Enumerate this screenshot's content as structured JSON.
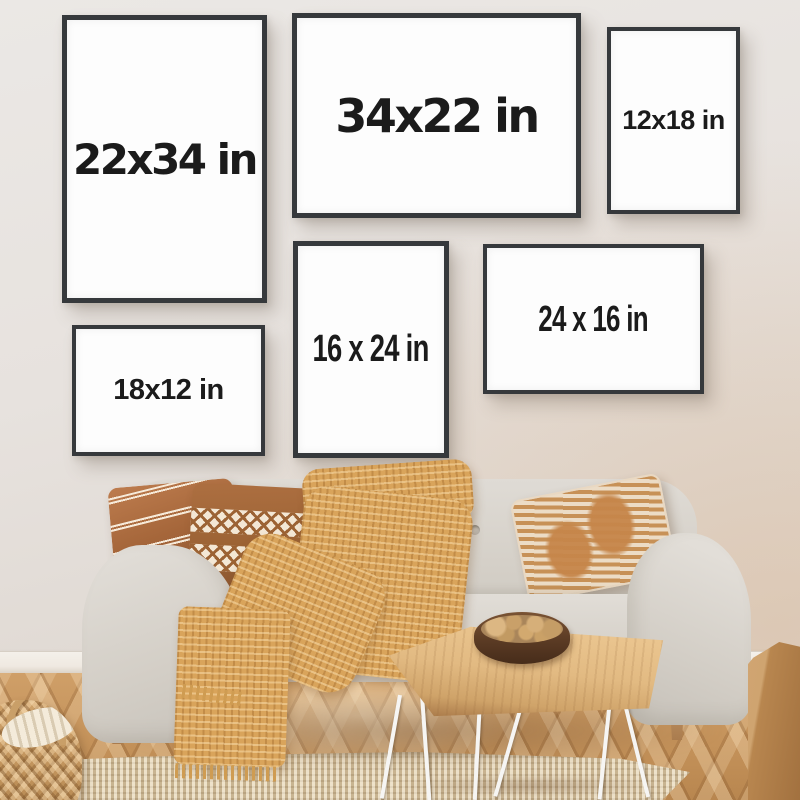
{
  "scene": {
    "type": "poster-frame-size-mockup-photo",
    "setting": "living room wall above a sofa"
  },
  "frames": [
    {
      "label": "22x34 in",
      "orientation": "portrait"
    },
    {
      "label": "34x22 in",
      "orientation": "landscape"
    },
    {
      "label": "12x18 in",
      "orientation": "portrait"
    },
    {
      "label": "16 x 24 in",
      "orientation": "portrait"
    },
    {
      "label": "24 x 16 in",
      "orientation": "landscape"
    },
    {
      "label": "18x12 in",
      "orientation": "landscape"
    }
  ],
  "colors": {
    "wall": "#e6e1dd",
    "frame_border": "#36393c",
    "frame_face": "#fdfdfd",
    "label_text": "#1b1b1b",
    "sofa": "#d6d2ca",
    "pillow_rust": "#a5663a",
    "pillow_cream": "#f3e7d4",
    "pillow_tan": "#c79157",
    "throw_blanket": "#d9a45b",
    "floor_wood": "#c4945e",
    "rug_jute": "#dcc9a8",
    "table_wood": "#e2ba82",
    "hairpin_legs": "#f6f5f3",
    "bowl": "#5b3b24",
    "basket_wicker": "#c59a63",
    "wood_block": "#b8864f",
    "baseboard": "#f2eee8"
  }
}
